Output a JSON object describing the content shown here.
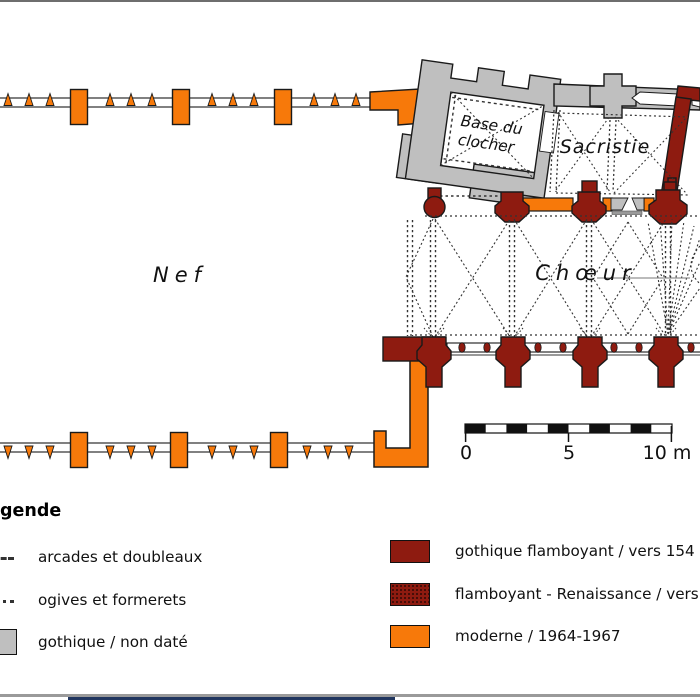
{
  "colors": {
    "orange": "#f7790a",
    "dark_red": "#8e1b10",
    "wall_gray": "#bfbfbf",
    "outline": "#1a1a1a",
    "frame_gray": "#9a9a9a",
    "navy_bar": "#20355e"
  },
  "plan": {
    "labels": {
      "nave": "Nef",
      "choir": "Chœur",
      "sacristy": "Sacristie",
      "tower_line1": "Base du",
      "tower_line2": "clocher"
    },
    "scale_ticks": {
      "t0": "0",
      "t5": "5",
      "t10": "10 m"
    }
  },
  "legend": {
    "title": "gende",
    "left_items": [
      {
        "symbol": "dashed-line",
        "label": "arcades et doubleaux"
      },
      {
        "symbol": "dotted-line",
        "label": "ogives et formerets"
      },
      {
        "symbol": "gray-box",
        "label": "gothique / non daté"
      }
    ],
    "right_items": [
      {
        "symbol": "dark-red-box",
        "label": "gothique flamboyant / vers 154"
      },
      {
        "symbol": "dark-red-stippled-box",
        "label": "flamboyant - Renaissance / vers"
      },
      {
        "symbol": "orange-box",
        "label": "moderne / 1964-1967"
      }
    ]
  }
}
